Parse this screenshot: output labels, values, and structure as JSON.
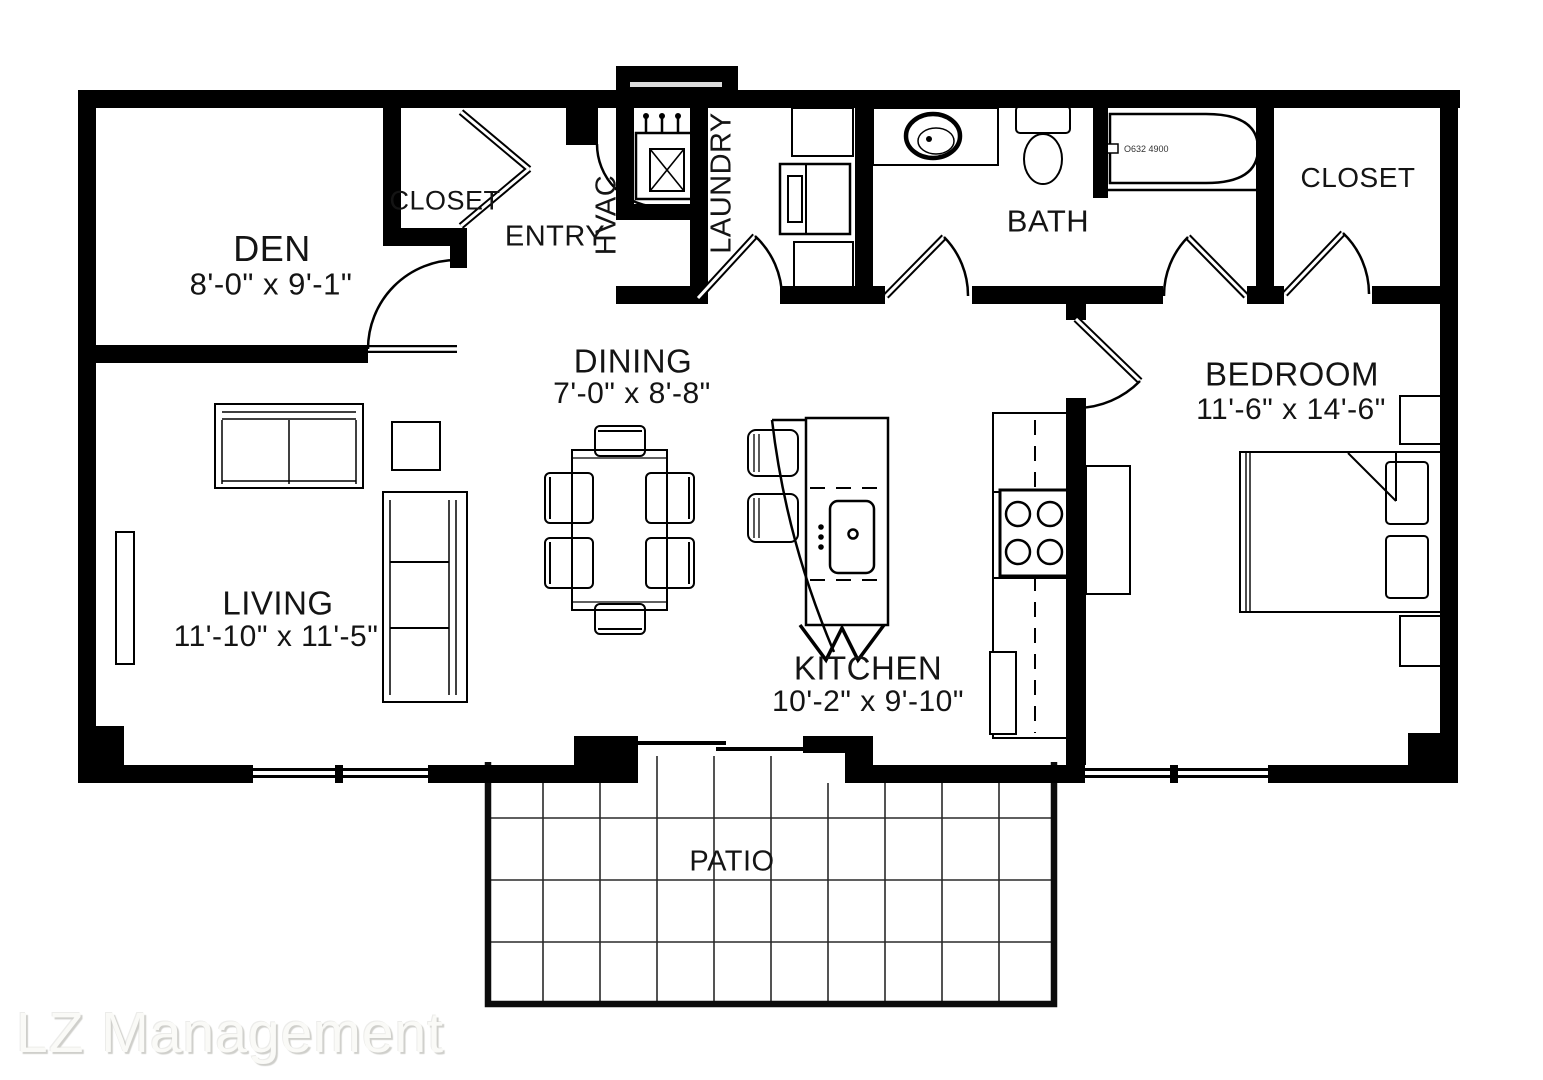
{
  "rooms": {
    "den": {
      "label": "DEN",
      "dimensions": "8'-0\" x 9'-1\""
    },
    "entry_closet": {
      "label": "CLOSET"
    },
    "entry": {
      "label": "ENTRY"
    },
    "hvac": {
      "label": "HVAC"
    },
    "laundry": {
      "label": "LAUNDRY"
    },
    "bath": {
      "label": "BATH"
    },
    "bedroom_closet": {
      "label": "CLOSET"
    },
    "bedroom": {
      "label": "BEDROOM",
      "dimensions": "11'-6\" x 14'-6\""
    },
    "dining": {
      "label": "DINING",
      "dimensions": "7'-0\" x 8'-8\""
    },
    "living": {
      "label": "LIVING",
      "dimensions": "11'-10\" x 11'-5\""
    },
    "kitchen": {
      "label": "KITCHEN",
      "dimensions": "10'-2\" x 9'-10\""
    },
    "patio": {
      "label": "PATIO"
    }
  },
  "annotations": {
    "watermark": "LZ Management",
    "tub_label": "O632 4900"
  },
  "colors": {
    "walls": "#000000",
    "background": "#ffffff",
    "watermark": "#fafaf7"
  }
}
